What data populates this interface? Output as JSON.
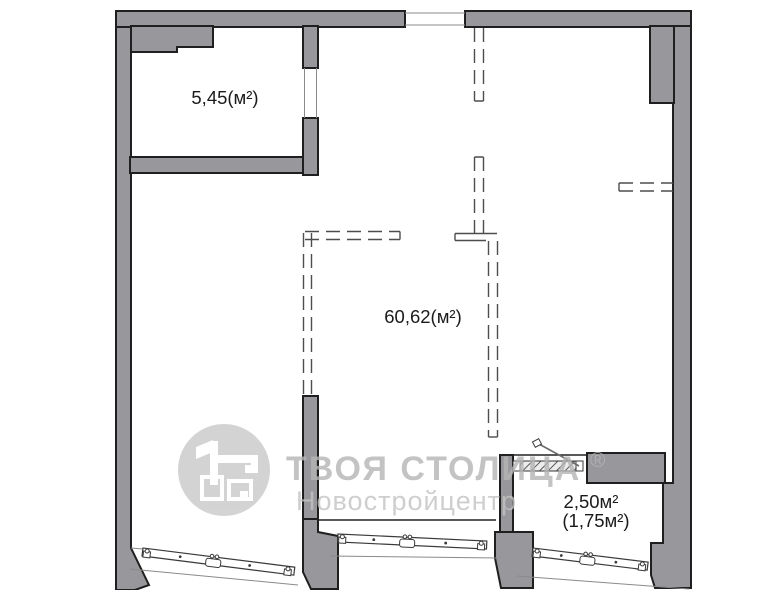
{
  "plan": {
    "title": "apartment floor plan",
    "rooms": [
      {
        "id": "storeroom",
        "area_label": "5,45(м²)"
      },
      {
        "id": "living-space",
        "area_label": "60,62(м²)"
      },
      {
        "id": "balcony",
        "area_label_total": "2,50м²",
        "area_label_reduced": "(1,75м²)"
      }
    ]
  },
  "watermark": {
    "brand": "ТВОЯ СТОЛИЦА",
    "registered_mark": "®",
    "subtitle": "Новостройцентр"
  },
  "colors": {
    "background": "#ffffff",
    "wall_fill": "#98989c",
    "outline": "#1f1f1f",
    "dashed_line": "#4d4d4d",
    "watermark_text": "#b5b5b5",
    "watermark_subtitle": "#c3c3c3",
    "watermark_logo": "#c9c9c9",
    "label_text": "#1b1b1b"
  }
}
